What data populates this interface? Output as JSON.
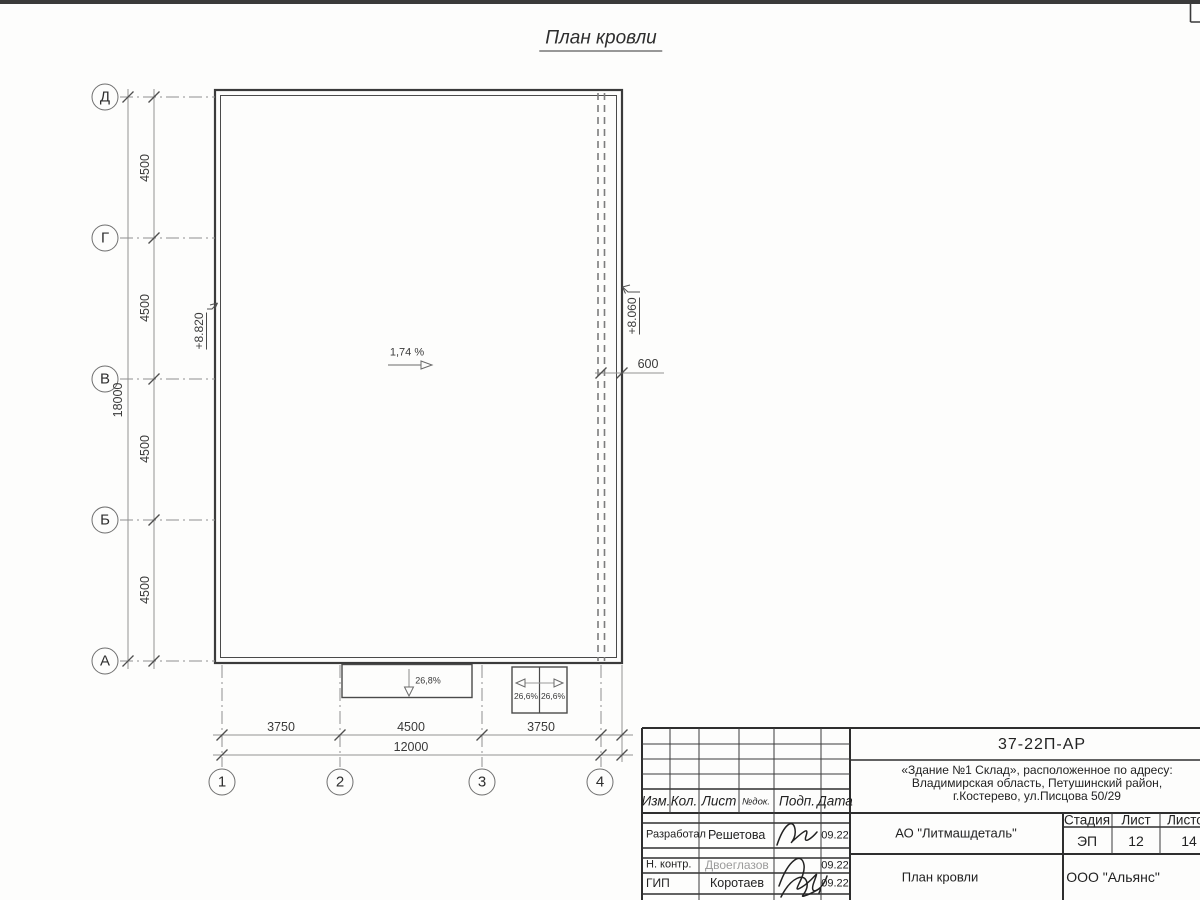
{
  "drawing_title": "План кровли",
  "plan": {
    "slope_label": "1,74 %",
    "elevation_left": "+8.820",
    "elevation_right": "+8.060",
    "offset_dim": "600",
    "canopy_center": {
      "slope": "26,8%"
    },
    "canopy_right": {
      "slope_left": "26,6%",
      "slope_right": "26,6%"
    },
    "row_axes": [
      "Д",
      "Г",
      "В",
      "Б",
      "А"
    ],
    "col_axes": [
      "1",
      "2",
      "3",
      "4"
    ],
    "vertical_dims": [
      "4500",
      "4500",
      "4500",
      "4500"
    ],
    "vertical_total": "18000",
    "horizontal_dims": [
      "3750",
      "4500",
      "3750"
    ],
    "horizontal_total": "12000"
  },
  "title_block": {
    "doc_number": "37-22П-АР",
    "address_lines": [
      "«Здание №1 Склад», расположенное по адресу:",
      "Владимирская область, Петушинский район,",
      "г.Костерево, ул.Писцова 50/29"
    ],
    "header_cols": [
      "Изм.",
      "Кол.",
      "Лист",
      "№док.",
      "Подп.",
      "Дата"
    ],
    "sign_rows": [
      {
        "role": "Разработал",
        "name": "Решетова",
        "date": "09.22"
      },
      {
        "role": "Н. контр.",
        "name": "Двоеглазов",
        "date": "09.22"
      },
      {
        "role": "ГИП",
        "name": "Коротаев",
        "date": "09.22"
      }
    ],
    "customer": "АО \"Литмашдеталь\"",
    "sheet_name": "План кровли",
    "organization": "ООО \"Альянс\"",
    "stage_label": "Стадия",
    "sheet_label": "Лист",
    "sheets_label": "Листов",
    "stage_value": "ЭП",
    "sheet_value": "12",
    "sheets_value": "14"
  }
}
